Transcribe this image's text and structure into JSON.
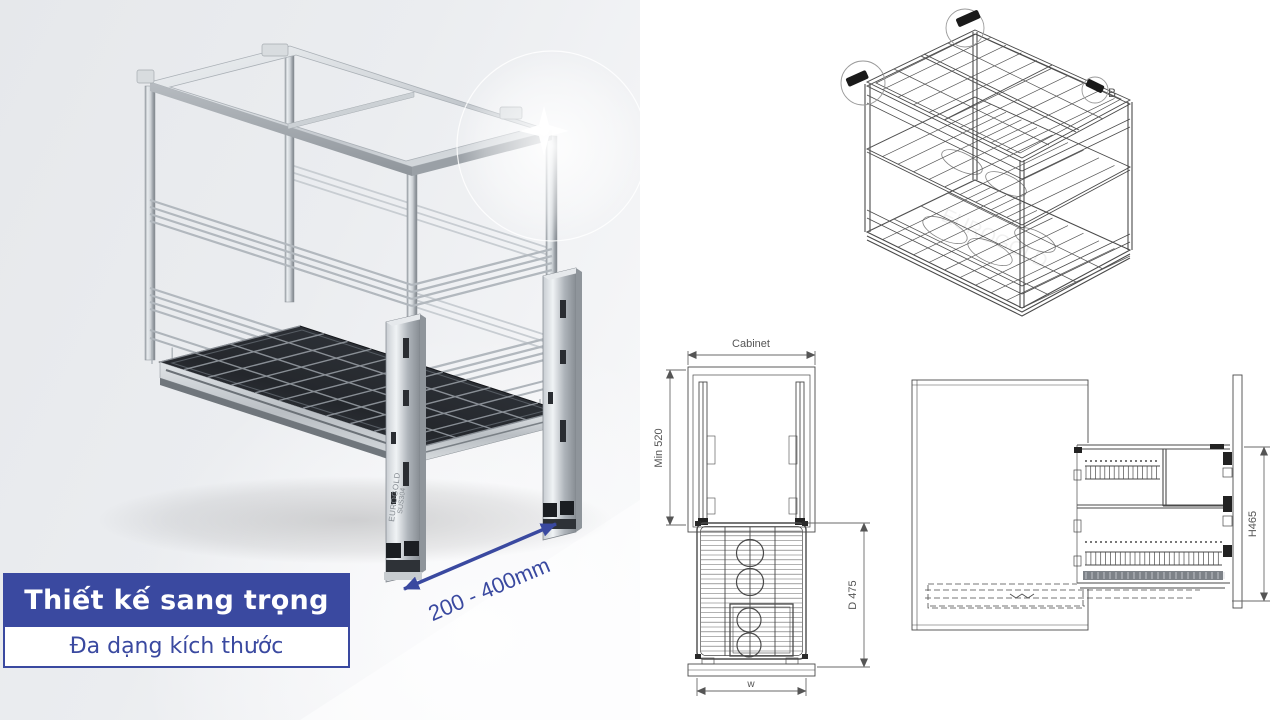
{
  "caption": {
    "title": "Thiết kế sang trọng",
    "subtitle": "Đa dạng kích thước"
  },
  "photo": {
    "dimension_label": "200 - 400mm",
    "etched_brand": "EUROGOLD",
    "etched_material": "SUS304"
  },
  "drawings": {
    "watermark": "EUROGOLD",
    "iso_view": {
      "detail_label": "B"
    },
    "front_view": {
      "cabinet_label": "Cabinet",
      "min_height_label": "Min 520",
      "depth_label": "D 475",
      "width_label": "w"
    },
    "side_view": {
      "height_label": "H465"
    }
  },
  "colors": {
    "accent_blue": "#3a49a0",
    "line_gray": "#4a4a4a",
    "tray_dark": "#2d3136",
    "photo_background": "#ebedf0"
  }
}
